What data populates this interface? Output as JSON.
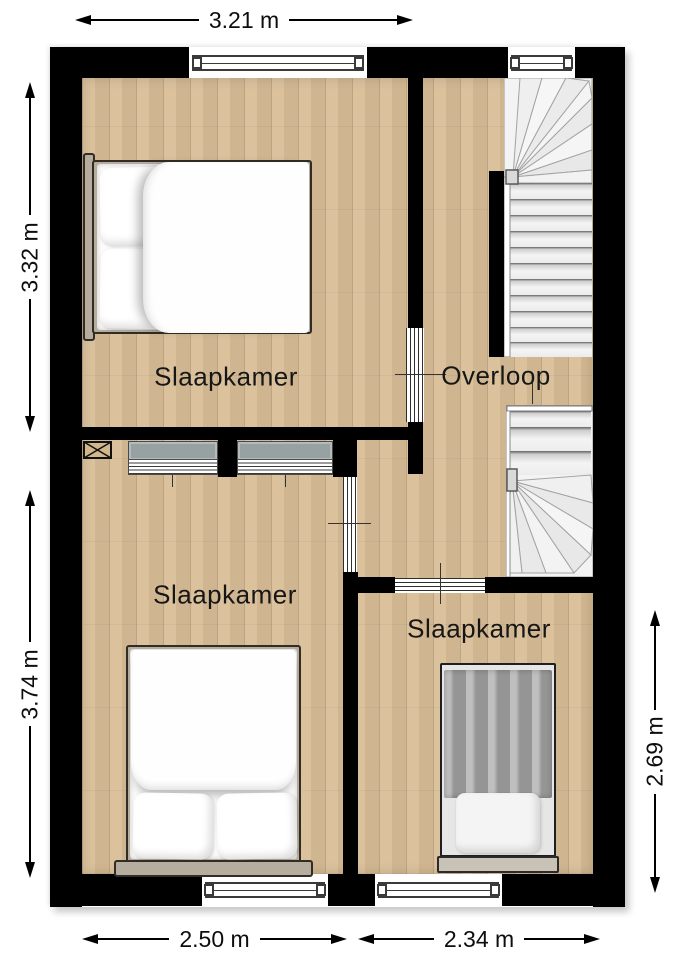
{
  "plan": {
    "rooms": [
      {
        "id": "slaapkamer-top-left",
        "name": "Slaapkamer"
      },
      {
        "id": "overloop",
        "name": "Overloop"
      },
      {
        "id": "slaapkamer-middle-left",
        "name": "Slaapkamer"
      },
      {
        "id": "slaapkamer-bottom-right",
        "name": "Slaapkamer"
      }
    ],
    "dimensions": [
      {
        "edge": "top",
        "value": "3.21 m"
      },
      {
        "edge": "left-upper",
        "value": "3.32 m"
      },
      {
        "edge": "left-lower",
        "value": "3.74 m"
      },
      {
        "edge": "right",
        "value": "2.69 m"
      },
      {
        "edge": "bottom-left",
        "value": "2.50 m"
      },
      {
        "edge": "bottom-right",
        "value": "2.34 m"
      }
    ],
    "colors": {
      "wall": "#000000",
      "floor": "#d8bd96",
      "stair_tread": "#f2f2f2",
      "closet": "#97a1a2",
      "bed_frame": "#b7ad9f",
      "single_bed_cover": "#a6a6a6"
    }
  }
}
